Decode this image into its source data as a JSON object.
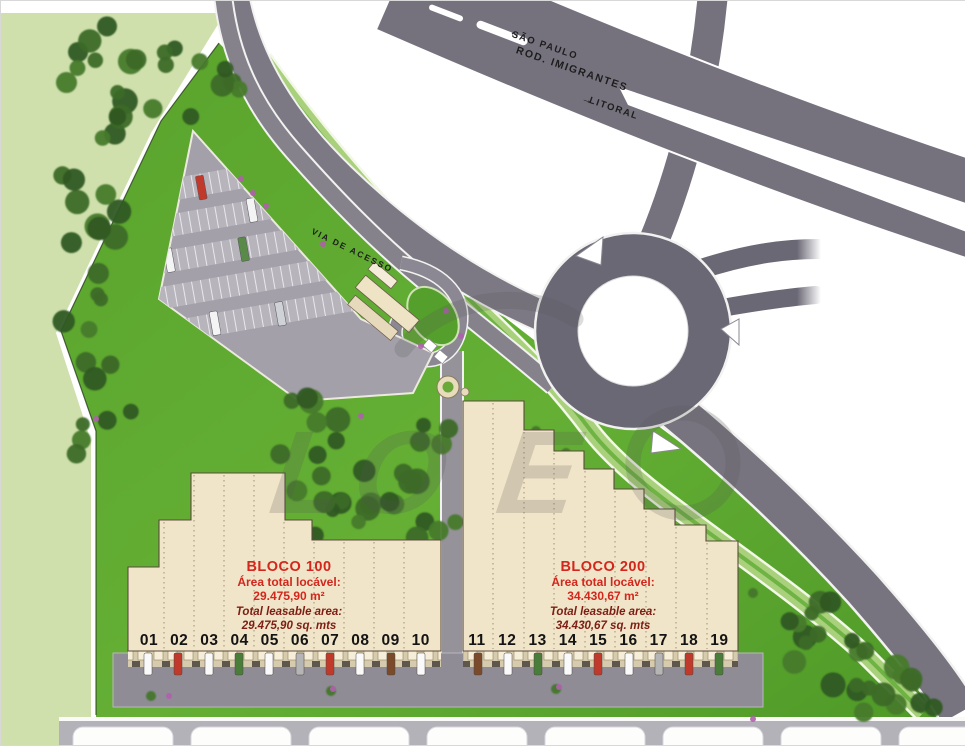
{
  "highway": {
    "name": "ROD. IMIGRANTES",
    "destination_left": "SÃO PAULO",
    "destination_right": "LITORAL"
  },
  "access_road": {
    "label": "VIA DE ACESSO"
  },
  "blocks": {
    "bloco100": {
      "title": "BLOCO 100",
      "area_label_pt": "Área total locável:",
      "area_value_pt": "29.475,90 m²",
      "area_label_en": "Total leasable area:",
      "area_value_en": "29.475,90 sq. mts",
      "units": [
        "01",
        "02",
        "03",
        "04",
        "05",
        "06",
        "07",
        "08",
        "09",
        "10"
      ]
    },
    "bloco200": {
      "title": "BLOCO 200",
      "area_label_pt": "Área total locável:",
      "area_value_pt": "34.430,67 m²",
      "area_label_en": "Total leasable area:",
      "area_value_en": "34.430,67 sq. mts",
      "units": [
        "11",
        "12",
        "13",
        "14",
        "15",
        "16",
        "17",
        "18",
        "19"
      ]
    }
  },
  "watermark": {
    "text": "LO E"
  },
  "icons": {
    "arrow_left": "←",
    "arrow_right": "→"
  },
  "colors": {
    "site_grass": "#60ab31",
    "field_grass": "#cfe0ad",
    "tree_green": "#3a6526",
    "road_gray": "#7e7b85",
    "highway_gray": "#757280",
    "parking_gray": "#a3a0a9",
    "building_beige": "#f1e5c9",
    "accent_red": "#d3261c",
    "accent_maroon": "#7e1d14"
  }
}
